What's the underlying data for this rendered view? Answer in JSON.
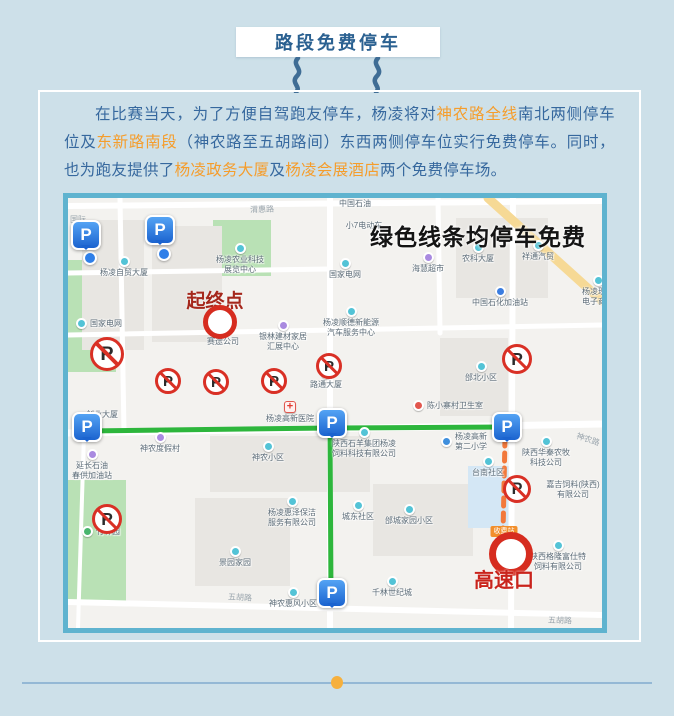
{
  "title": {
    "text": "路段免费停车"
  },
  "intro": {
    "segments": [
      {
        "t": "在比赛当天，为了方便自驾跑友停车，杨凌将对",
        "hl": false
      },
      {
        "t": "神农路全线",
        "hl": true
      },
      {
        "t": "南北两侧停车位及",
        "hl": false
      },
      {
        "t": "东新路南段",
        "hl": true
      },
      {
        "t": "（神农路至五胡路间）东西两侧停车位实行免费停车。同时，也为跑友提供了",
        "hl": false
      },
      {
        "t": "杨凌政务大厦",
        "hl": true
      },
      {
        "t": "及",
        "hl": false
      },
      {
        "t": "杨凌会展酒店",
        "hl": true
      },
      {
        "t": "两个免费停车场。",
        "hl": false
      }
    ]
  },
  "colors": {
    "page_bg": "#cde0e9",
    "text_blue": "#36689e",
    "highlight_orange": "#f59d2c",
    "map_border": "#5fb3cf",
    "route_green": "#2db63c",
    "route_orange": "#f2793c",
    "marker_red": "#d62c1f"
  },
  "map": {
    "headline": {
      "text": "绿色线条均停车免费",
      "x": 410,
      "y": 20
    },
    "start": {
      "label": "起终点",
      "x": 147,
      "y": 119
    },
    "highway": {
      "label": "高速口",
      "badge": "收费站",
      "x": 436,
      "y": 349
    },
    "parking_glyph": "P",
    "no_parking_glyph": "P",
    "greens": [
      [
        0,
        62,
        48,
        112
      ],
      [
        145,
        22,
        58,
        56
      ],
      [
        0,
        282,
        58,
        124
      ]
    ],
    "buildings": [
      [
        14,
        22,
        62,
        130
      ],
      [
        84,
        28,
        70,
        116
      ],
      [
        388,
        20,
        92,
        80
      ],
      [
        372,
        140,
        68,
        78
      ],
      [
        142,
        238,
        160,
        56
      ],
      [
        305,
        286,
        100,
        72
      ],
      [
        127,
        300,
        95,
        88
      ]
    ],
    "water": [
      [
        400,
        268,
        42,
        62
      ]
    ],
    "lines": [
      {
        "name": "road",
        "pts": [
          [
            0,
            8
          ],
          [
            534,
            3
          ]
        ],
        "color": "#ffffff",
        "w": 6
      },
      {
        "name": "road",
        "pts": [
          [
            0,
            75
          ],
          [
            262,
            71
          ]
        ],
        "color": "#ffffff",
        "w": 5
      },
      {
        "name": "road",
        "pts": [
          [
            0,
            137
          ],
          [
            534,
            127
          ]
        ],
        "color": "#ffffff",
        "w": 5
      },
      {
        "name": "road",
        "pts": [
          [
            0,
            235
          ],
          [
            534,
            226
          ]
        ],
        "color": "#ffffff",
        "w": 7
      },
      {
        "name": "road",
        "pts": [
          [
            0,
            404
          ],
          [
            534,
            417
          ]
        ],
        "color": "#ffffff",
        "w": 6
      },
      {
        "name": "road",
        "pts": [
          [
            52,
            0
          ],
          [
            56,
            235
          ]
        ],
        "color": "#ffffff",
        "w": 5
      },
      {
        "name": "road",
        "pts": [
          [
            16,
            235
          ],
          [
            10,
            430
          ]
        ],
        "color": "#ffffff",
        "w": 4
      },
      {
        "name": "road",
        "pts": [
          [
            262,
            0
          ],
          [
            262,
            430
          ]
        ],
        "color": "#ffffff",
        "w": 6
      },
      {
        "name": "road",
        "pts": [
          [
            445,
            0
          ],
          [
            443,
            430
          ]
        ],
        "color": "#ffffff",
        "w": 6
      },
      {
        "name": "road",
        "pts": [
          [
            370,
            0
          ],
          [
            372,
            135
          ]
        ],
        "color": "#ffffff",
        "w": 5
      },
      {
        "name": "yellow-road",
        "pts": [
          [
            420,
            0
          ],
          [
            534,
            103
          ]
        ],
        "color": "#f6d995",
        "w": 9
      },
      {
        "name": "free-parking-route",
        "pts": [
          [
            17,
            233
          ],
          [
            262,
            230
          ],
          [
            437,
            229
          ]
        ],
        "color": "#2db63c",
        "w": 5
      },
      {
        "name": "free-parking-route",
        "pts": [
          [
            262,
            230
          ],
          [
            263,
            396
          ]
        ],
        "color": "#2db63c",
        "w": 5
      },
      {
        "name": "highway-route",
        "pts": [
          [
            437,
            240
          ],
          [
            435,
            336
          ]
        ],
        "color": "#f2793c",
        "w": 5,
        "dash": "8 7"
      }
    ],
    "road_labels": [
      {
        "t": "渭惠路",
        "x": 182,
        "y": 6,
        "r": -2
      },
      {
        "t": "国际",
        "x": 2,
        "y": 16,
        "r": 0
      },
      {
        "t": "神农路",
        "x": 508,
        "y": 236,
        "r": 18
      },
      {
        "t": "五胡路",
        "x": 160,
        "y": 394,
        "r": 3
      },
      {
        "t": "五胡路",
        "x": 480,
        "y": 417,
        "r": 2
      }
    ],
    "pois": [
      {
        "t": "中国石油",
        "x": 287,
        "y": 0,
        "icon": "none"
      },
      {
        "t": "小7电动车",
        "x": 296,
        "y": 22,
        "icon": "none"
      },
      {
        "t": "杨凌自贸大厦",
        "x": 56,
        "y": 58,
        "icon": "teal"
      },
      {
        "lines": [
          "杨凌农业科技",
          "展览中心"
        ],
        "x": 172,
        "y": 45,
        "icon": "teal"
      },
      {
        "t": "国家电网",
        "x": 277,
        "y": 60,
        "icon": "teal"
      },
      {
        "t": "海慧超市",
        "x": 360,
        "y": 54,
        "icon": "purple"
      },
      {
        "t": "农科大厦",
        "x": 410,
        "y": 44,
        "icon": "teal"
      },
      {
        "t": "祥通汽贸",
        "x": 470,
        "y": 42,
        "icon": "teal"
      },
      {
        "lines": [
          "杨凌现代",
          "电子商务"
        ],
        "x": 530,
        "y": 77,
        "icon": "teal"
      },
      {
        "t": "中国石化加油站",
        "x": 432,
        "y": 88,
        "icon": "gas"
      },
      {
        "t": "国家电网",
        "x": 14,
        "y": 122,
        "icon": "teal",
        "layout": "h"
      },
      {
        "lines": [
          "杨凌顺德新能源",
          "汽车服务中心"
        ],
        "x": 283,
        "y": 108,
        "icon": "teal"
      },
      {
        "t": "赛途公司",
        "x": 155,
        "y": 127,
        "icon": "teal"
      },
      {
        "lines": [
          "银林建材家居",
          "汇展中心"
        ],
        "x": 215,
        "y": 122,
        "icon": "purple"
      },
      {
        "t": "路通大厦",
        "x": 258,
        "y": 170,
        "icon": "teal"
      },
      {
        "t": "邰北小区",
        "x": 413,
        "y": 163,
        "icon": "teal"
      },
      {
        "t": "杨凌高新医院",
        "x": 222,
        "y": 203,
        "icon": "cross"
      },
      {
        "t": "陈小寨村卫生室",
        "x": 351,
        "y": 204,
        "icon": "redpin",
        "layout": "h"
      },
      {
        "t": "创业大厦",
        "x": 34,
        "y": 211,
        "icon": "none"
      },
      {
        "t": "神农度假村",
        "x": 92,
        "y": 234,
        "icon": "purple"
      },
      {
        "lines": [
          "延长石油",
          "春供加油站"
        ],
        "x": 24,
        "y": 251,
        "icon": "purple"
      },
      {
        "t": "神农小区",
        "x": 200,
        "y": 243,
        "icon": "teal"
      },
      {
        "lines": [
          "陕西石羊集团杨凌",
          "饲料科技有限公司"
        ],
        "x": 296,
        "y": 229,
        "icon": "teal"
      },
      {
        "lines": [
          "杨凌高新",
          "第二小学"
        ],
        "x": 379,
        "y": 235,
        "icon": "school",
        "layout": "h"
      },
      {
        "t": "台南社区",
        "x": 420,
        "y": 258,
        "icon": "teal"
      },
      {
        "lines": [
          "陕西华秦农牧",
          "科技公司"
        ],
        "x": 478,
        "y": 238,
        "icon": "teal"
      },
      {
        "lines": [
          "嘉吉饲料(陕西)",
          "有限公司"
        ],
        "x": 505,
        "y": 281,
        "icon": "none"
      },
      {
        "lines": [
          "杨凌惠泽保洁",
          "服务有限公司"
        ],
        "x": 224,
        "y": 298,
        "icon": "teal"
      },
      {
        "t": "城东社区",
        "x": 290,
        "y": 302,
        "icon": "teal"
      },
      {
        "t": "邰城家园小区",
        "x": 341,
        "y": 306,
        "icon": "teal"
      },
      {
        "t": "竹林园",
        "x": 20,
        "y": 330,
        "icon": "green",
        "layout": "h"
      },
      {
        "lines": [
          "陕西格隆富仕特",
          "饲料有限公司"
        ],
        "x": 490,
        "y": 342,
        "icon": "teal"
      },
      {
        "t": "景园家园",
        "x": 167,
        "y": 348,
        "icon": "teal"
      },
      {
        "t": "千林世纪城",
        "x": 324,
        "y": 378,
        "icon": "teal"
      },
      {
        "t": "神农惠风小区",
        "x": 225,
        "y": 389,
        "icon": "teal"
      }
    ],
    "parking": [
      [
        16,
        38
      ],
      [
        90,
        33
      ],
      [
        17,
        230
      ],
      [
        262,
        226
      ],
      [
        437,
        230
      ],
      [
        262,
        396
      ]
    ],
    "dots": [
      [
        20,
        58
      ],
      [
        94,
        54
      ]
    ],
    "no_parking": [
      [
        39,
        156,
        34
      ],
      [
        100,
        183,
        26
      ],
      [
        148,
        184,
        26
      ],
      [
        206,
        183,
        26
      ],
      [
        261,
        168,
        26
      ],
      [
        449,
        161,
        30
      ],
      [
        449,
        291,
        28
      ],
      [
        39,
        321,
        30
      ]
    ]
  }
}
